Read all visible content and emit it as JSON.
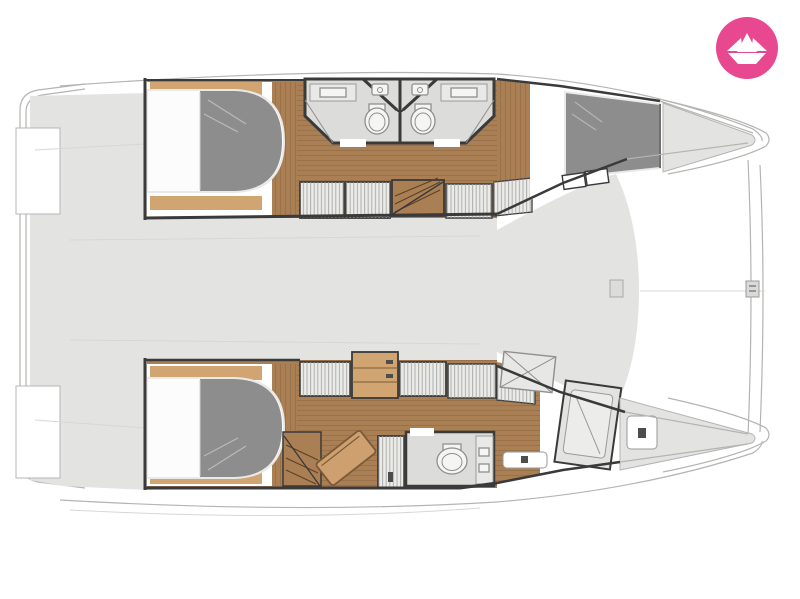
{
  "colors": {
    "page_bg": "#ffffff",
    "logo_pink": "#e8488f",
    "logo_glyph": "#ffffff",
    "deck": "#e3e3e1",
    "outline": "#b4b4b2",
    "faint_line": "#d7d7d5",
    "wall": "#3a3a3a",
    "wood": "#aa7f54",
    "wood_light": "#d0a571",
    "wood_plank_line": "#6f5134",
    "mattress": "#8d8d8d",
    "sheet": "#fcfcfc",
    "bed_trim": "#e9e9e7",
    "bath_floor": "#dcdcda",
    "fixture": "#f5f5f4",
    "fixture_line": "#8f8f8d",
    "locker": "#ebebe8",
    "locker_line": "#a3a3a1",
    "seat": "#cfa06f"
  },
  "logo": {
    "icon": "paper-boat-icon"
  },
  "floorplan": {
    "type": "catamaran cabin layout, top-down, bow left",
    "upper_hull_features": [
      "forward-double-bed",
      "ensuite-bathroom-left",
      "ensuite-bathroom-right",
      "twin-sinks",
      "toilets",
      "wardrobes",
      "companionway-stairs",
      "aft-double-bed",
      "stern-steps"
    ],
    "lower_hull_features": [
      "forward-double-bed",
      "wardrobes",
      "dresser",
      "companionway-stairs",
      "lounge-seat",
      "hanging-locker",
      "bathroom-toilet",
      "vanity",
      "shower-stall",
      "skylight-hatch",
      "stern-locker"
    ],
    "deck_features": [
      "bow-platform",
      "bow-step-notches",
      "foredeck",
      "cockpit",
      "transom-line",
      "centerline-mark"
    ]
  }
}
